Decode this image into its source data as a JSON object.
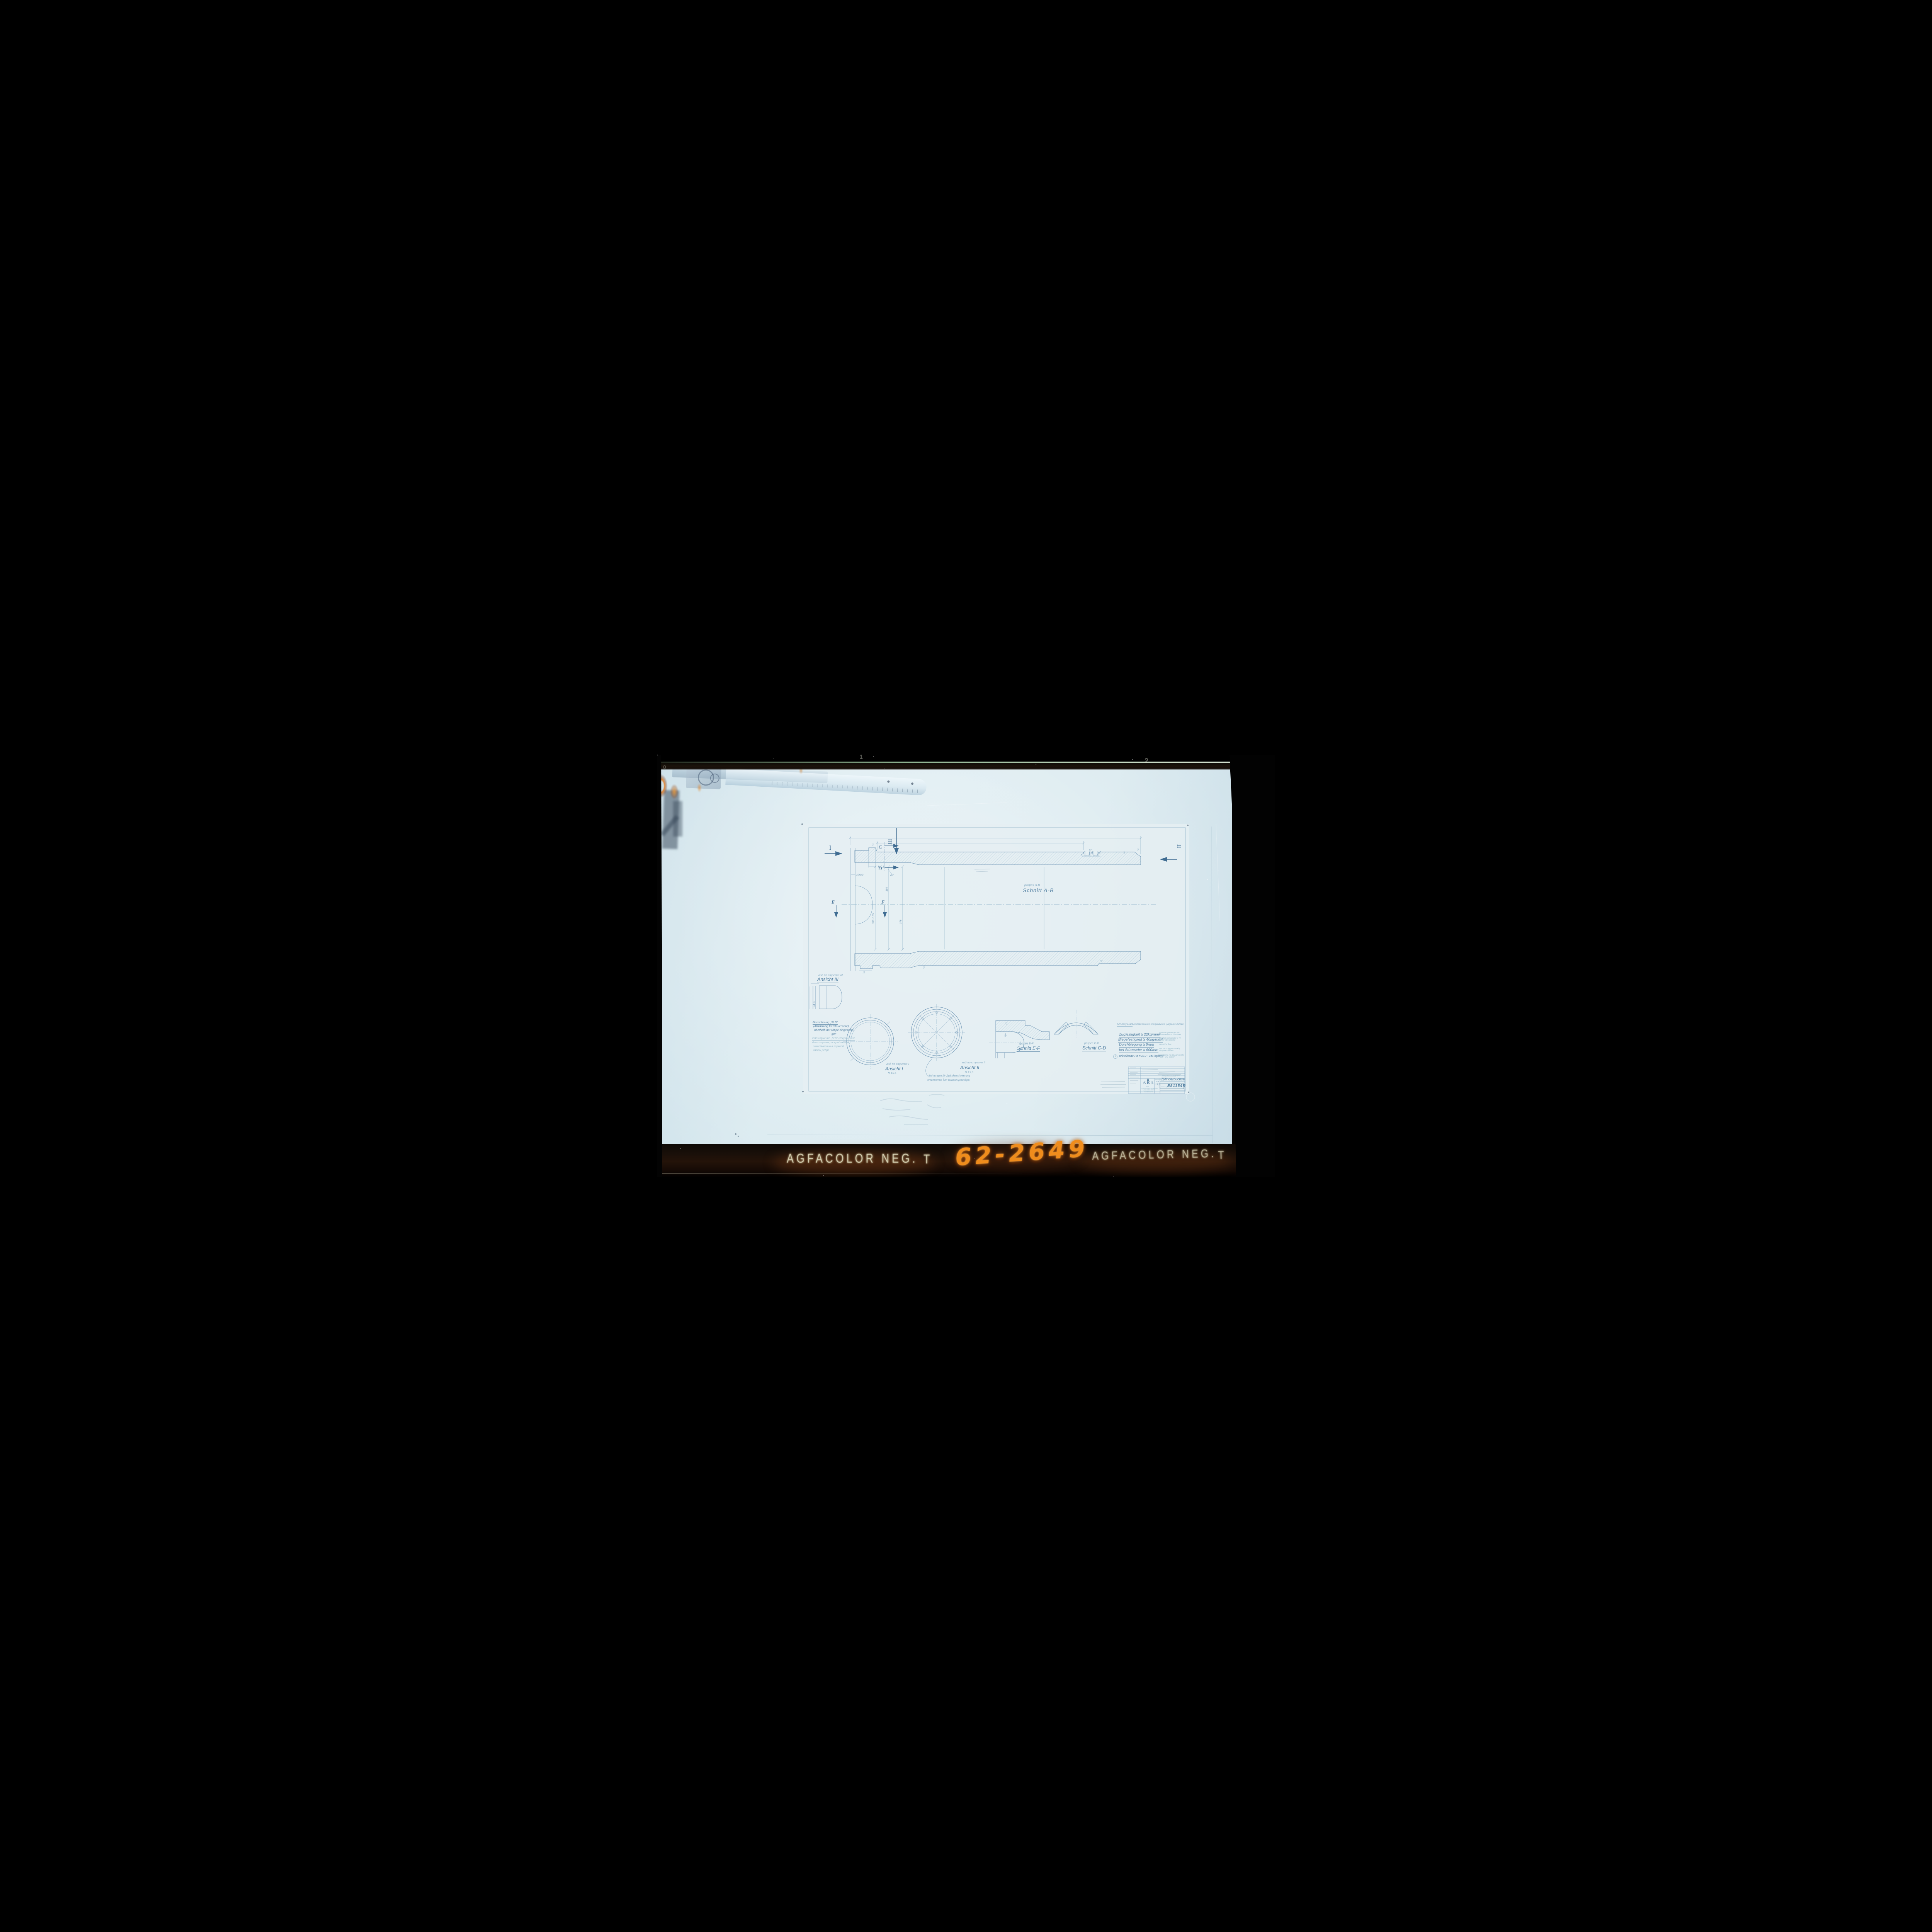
{
  "colors": {
    "blueprint_line": "#6e95b4",
    "label_blue": "#4f7da0",
    "faint_ru_blue": "#97bacb",
    "paper": "#e6eff3",
    "backdrop": "#d7e8ee",
    "film_orange": "#ef8c1c",
    "brand_cream": "#e4e1c2"
  },
  "film": {
    "frame_number_0": "0",
    "frame_number_1": "1",
    "frame_number_2": "2",
    "brand_left": "AGFACOLOR NEG.",
    "brand_left_suffix": "T",
    "brand_right": "AGFACOLOR NEG.",
    "brand_right_suffix": "T",
    "handwritten_id": "62-2649"
  },
  "drawing": {
    "section_main": {
      "ru": "разрез A-B",
      "de": "Schnitt A-B"
    },
    "view1": {
      "ru": "вид по стрелке I",
      "de": "Ansicht I",
      "scale": "M 1:2,5"
    },
    "view2": {
      "ru": "вид по стрелке II",
      "de": "Ansicht II",
      "scale": "M 1:2,5"
    },
    "view3": {
      "ru": "вид по стрелке III",
      "de": "Ansicht III"
    },
    "section_ef": {
      "ru": "разрез E-F",
      "de": "Schnitt E-F"
    },
    "section_cd": {
      "ru": "разрез C-D",
      "de": "Schnitt C-D"
    },
    "lube_note": {
      "de": "Bohrungen für Zylinderschmierung",
      "ru": "отверстия для смазки цилиндра"
    },
    "marking_note": {
      "de1": "Bezeichnung „St S“",
      "de2": "(Abkürzung für Steuerseite)",
      "de3": "oberhalb der Rippe eingeschla-",
      "de4": "gen",
      "ru1": "Опознаучение „St S“ (сокращение",
      "ru2": "для стороны распредижения)",
      "ru3": "заклеймовано в верхней",
      "ru4": "части ребра"
    },
    "material": {
      "label": "Материал",
      "value": "Центробежное специальное чугунное литье"
    },
    "properties": [
      {
        "de": "Zugfestigkeit ≥ 22kg/mm²",
        "ru": "Предел прочности при растяжении ≥ 22 кг/мм²"
      },
      {
        "de": "Biegefestigkeit ≥ 40kg/mm²",
        "ru": "Предел прочности ≥ 40 кг/мм² при изгибе"
      },
      {
        "de": "Durchbiegung ≥ 9mm",
        "ru": "прогиб ≥ 9мм"
      },
      {
        "de": "bei Stützweite = 600mm",
        "ru": "при расстоянии между опорами 600мм"
      }
    ],
    "brinell": {
      "prefix": "a",
      "de": "Brinellhärte  Hв = 210 - 241 kg/mm²",
      "ru": "Твердость по Бринеллю Hв = 210 - 241 кг/мм²"
    },
    "rib_mark": "St S",
    "markers": {
      "i": "I",
      "ii": "II",
      "iii": "III",
      "c": "C",
      "d": "D",
      "e": "E",
      "f": "F"
    },
    "dims": {
      "lip": "8±0,1",
      "wall": "10+0,3",
      "chamfer": "45°",
      "groove1": "8+0,1",
      "groove2": "8+0,1",
      "groove3": "8+0,1",
      "angle30": "30°",
      "angle15": "15°",
      "dia380": "380+0,05",
      "dia356": "356",
      "dia378": "378",
      "step12": "12",
      "ef_angle20": "20°",
      "ef_angle15": "15°"
    },
    "title_block": {
      "logo": "SKL",
      "org1": "VEB",
      "org2": "SCHWERMASCHINENBAU",
      "org3": "KARL LIEBKNECHT",
      "org4": "MAGDEBURG",
      "part_ru": "втулка цилиндра",
      "part_de": "Zylinderbuchse",
      "dwg_label": "Zeichnungs-Nr.",
      "dwg_no": "E81154R",
      "scale_label": "Maßstab",
      "scale1": "1:1",
      "scale2": "1:2,5"
    }
  }
}
